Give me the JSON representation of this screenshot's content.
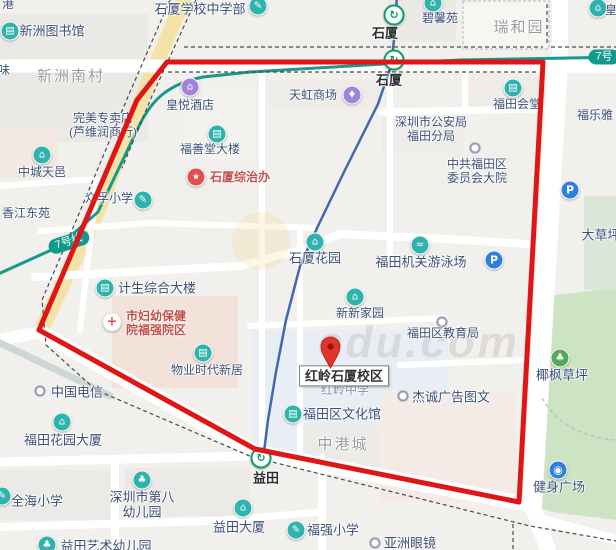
{
  "map": {
    "colors": {
      "boundary": "#e01515",
      "metro_line7": "#17998c",
      "poi_teal": "#2fb3ac",
      "poi_purple": "#a184d8",
      "poi_blue": "#2f7fe0",
      "poi_red": "#e0504c",
      "river": "#3f68b0",
      "park_green": "#cde4c4"
    },
    "watermark": "edu.com",
    "badges": [
      {
        "text": "7号线",
        "x": 69,
        "y": 242,
        "rot": -18
      },
      {
        "text": "7号",
        "x": 604,
        "y": 57,
        "rot": 0
      }
    ],
    "pois": [
      {
        "id": "shixia-school-middle",
        "label": "石厦学校中学部",
        "style": "big",
        "tx": 200,
        "ty": 9,
        "icon": "school",
        "ix": 258,
        "iy": 6
      },
      {
        "id": "harbor-partial",
        "label": "港",
        "tx": 8,
        "ty": 4
      },
      {
        "id": "xinzhou-library",
        "label": "新洲图书馆",
        "style": "big",
        "tx": 52,
        "ty": 31,
        "icon": "library",
        "ix": 10,
        "iy": 31
      },
      {
        "id": "bixinyuan",
        "label": "碧馨苑",
        "tx": 440,
        "ty": 18,
        "icon": "residence",
        "ix": 433,
        "iy": 3
      },
      {
        "id": "ruiheyuan",
        "label": "瑞和园",
        "style": "gray",
        "tx": 519,
        "ty": 28
      },
      {
        "id": "huang-partial",
        "label": "皇",
        "tx": 611,
        "ty": 10,
        "icon": "residence",
        "ix": 598,
        "iy": 8
      },
      {
        "id": "shixia-station-north",
        "label": "石厦",
        "style": "station",
        "tx": 385,
        "ty": 33,
        "icon": "metro",
        "ix": 394,
        "iy": 15
      },
      {
        "id": "shixia-station-south",
        "label": "石厦",
        "style": "station",
        "tx": 389,
        "ty": 80,
        "icon": "metro",
        "ix": 394,
        "iy": 60
      },
      {
        "id": "tianhong-mall",
        "label": "天虹商场",
        "tx": 313,
        "ty": 95,
        "icon": "shopping",
        "ix": 352,
        "iy": 95
      },
      {
        "id": "fuleya",
        "label": "福乐雅",
        "tx": 595,
        "ty": 115
      },
      {
        "id": "futian-huitang",
        "label": "福田会堂",
        "tx": 517,
        "ty": 104,
        "icon": "office",
        "ix": 513,
        "iy": 88
      },
      {
        "id": "shenzhen-police",
        "lines": [
          "深圳市公安局",
          "福田分局"
        ],
        "tx": 431,
        "ty": 129
      },
      {
        "id": "futian-committee",
        "lines": [
          "中共福田区",
          "委员会大院"
        ],
        "tx": 477,
        "ty": 171,
        "icon": "dot",
        "ix": 475,
        "iy": 148
      },
      {
        "id": "wanmei-store",
        "lines": [
          "完美专卖店",
          "(芦维润商行)"
        ],
        "tx": 103,
        "ty": 125
      },
      {
        "id": "huangyue-hotel",
        "label": "皇悦酒店",
        "tx": 190,
        "ty": 105,
        "icon": "hotel",
        "ix": 190,
        "iy": 87
      },
      {
        "id": "xinzhou-nancun",
        "label": "新洲南村",
        "style": "gray",
        "tx": 71,
        "ty": 77
      },
      {
        "id": "wei-partial",
        "label": "味",
        "tx": 4,
        "ty": 70
      },
      {
        "id": "fushantang-building",
        "label": "福善堂大楼",
        "tx": 210,
        "ty": 149,
        "icon": "office",
        "ix": 217,
        "iy": 134
      },
      {
        "id": "shixia-zongzhiban",
        "label": "石厦综治办",
        "style": "red",
        "tx": 240,
        "ty": 177,
        "icon": "government",
        "ix": 196,
        "iy": 177
      },
      {
        "id": "zhongfu-primary",
        "label": "众孚小学",
        "tx": 109,
        "ty": 198,
        "icon": "school",
        "ix": 143,
        "iy": 200
      },
      {
        "id": "zhongcheng-tianyi",
        "label": "中城天邑",
        "tx": 42,
        "ty": 172,
        "icon": "residence",
        "ix": 42,
        "iy": 155
      },
      {
        "id": "xiangjiang-dongyuan",
        "label": "香江东苑",
        "tx": 26,
        "ty": 213
      },
      {
        "id": "dacaoping",
        "label": "大草坪",
        "style": "big",
        "tx": 601,
        "ty": 235
      },
      {
        "id": "shixia-huayuan",
        "label": "石厦花园",
        "style": "big",
        "tx": 315,
        "ty": 258,
        "icon": "residence",
        "ix": 315,
        "iy": 242
      },
      {
        "id": "futian-swimming",
        "label": "福田机关游泳场",
        "style": "big",
        "tx": 421,
        "ty": 262,
        "icon": "swim",
        "ix": 420,
        "iy": 245
      },
      {
        "id": "parking-north",
        "label": "",
        "tx": 570,
        "ty": 205,
        "icon": "parking",
        "ix": 570,
        "iy": 190
      },
      {
        "id": "parking-pool",
        "label": "",
        "tx": 494,
        "ty": 275,
        "icon": "parking",
        "ix": 494,
        "iy": 260
      },
      {
        "id": "jisheng-building",
        "label": "计生综合大楼",
        "style": "big",
        "tx": 157,
        "ty": 288,
        "icon": "office",
        "ix": 105,
        "iy": 288
      },
      {
        "id": "fuyou-hospital",
        "lines": [
          "市妇幼保健",
          "院福强院区"
        ],
        "style": "red",
        "tx": 156,
        "ty": 323,
        "icon": "hospital",
        "ix": 112,
        "iy": 322
      },
      {
        "id": "xinxin-jiayuan",
        "label": "新新家园",
        "tx": 360,
        "ty": 313,
        "icon": "residence",
        "ix": 355,
        "iy": 297
      },
      {
        "id": "futian-education",
        "label": "福田区教育局",
        "tx": 443,
        "ty": 333,
        "icon": "dot",
        "ix": 442,
        "iy": 322
      },
      {
        "id": "yefeng-lawn",
        "label": "椰枫草坪",
        "style": "big",
        "tx": 562,
        "ty": 375,
        "icon": "park",
        "ix": 560,
        "iy": 358
      },
      {
        "id": "wuye-shidai",
        "label": "物业时代新居",
        "tx": 207,
        "ty": 370,
        "icon": "office",
        "ix": 203,
        "iy": 353
      },
      {
        "id": "hongling-middle",
        "label": "红岭中学",
        "style": "muted",
        "tx": 345,
        "ty": 390
      },
      {
        "id": "hongling-shixia-campus",
        "label": "红岭石厦校区",
        "style": "box",
        "tx": 344,
        "ty": 376
      },
      {
        "id": "china-telecom",
        "label": "中国电信",
        "style": "big",
        "tx": 77,
        "ty": 392,
        "icon": "dot",
        "ix": 40,
        "iy": 391
      },
      {
        "id": "jiecheng-ad",
        "label": "杰诚广告图文",
        "style": "big",
        "tx": 451,
        "ty": 397,
        "icon": "dot",
        "ix": 403,
        "iy": 396
      },
      {
        "id": "futian-culture-hall",
        "label": "福田区文化馆",
        "style": "big",
        "tx": 342,
        "ty": 414,
        "icon": "office",
        "ix": 293,
        "iy": 414
      },
      {
        "id": "zhonggangcheng",
        "label": "中港城",
        "style": "gray",
        "tx": 343,
        "ty": 445
      },
      {
        "id": "futian-garden-tower",
        "label": "福田花园大厦",
        "style": "big",
        "tx": 63,
        "ty": 440,
        "icon": "residence",
        "ix": 62,
        "iy": 422
      },
      {
        "id": "yitian-station",
        "label": "益田",
        "style": "station",
        "tx": 266,
        "ty": 478,
        "icon": "metro",
        "ix": 261,
        "iy": 458
      },
      {
        "id": "quanhai-primary",
        "label": "全海小学",
        "style": "big",
        "tx": 37,
        "ty": 501,
        "icon": "school",
        "ix": 2,
        "iy": 496
      },
      {
        "id": "no8-kindergarten",
        "lines": [
          "深圳市第八",
          "幼儿园"
        ],
        "style": "big",
        "tx": 142,
        "ty": 505,
        "icon": "kindergarten",
        "ix": 142,
        "iy": 480
      },
      {
        "id": "jianshen-square",
        "label": "健身广场",
        "style": "big",
        "tx": 559,
        "ty": 487,
        "icon": "gym",
        "ix": 558,
        "iy": 470
      },
      {
        "id": "yitian-tower",
        "label": "益田大厦",
        "style": "big",
        "tx": 239,
        "ty": 527,
        "icon": "residence",
        "ix": 243,
        "iy": 508
      },
      {
        "id": "fuqiang-primary",
        "label": "福强小学",
        "style": "big",
        "tx": 333,
        "ty": 530,
        "icon": "school",
        "ix": 296,
        "iy": 530
      },
      {
        "id": "yazhou-glasses",
        "label": "亚洲眼镜",
        "style": "big",
        "tx": 410,
        "ty": 543,
        "icon": "dot",
        "ix": 375,
        "iy": 543
      },
      {
        "id": "yitian-art-kindergarten",
        "label": "益田艺术幼儿园",
        "style": "big",
        "tx": 106,
        "ty": 546,
        "icon": "kindergarten",
        "ix": 47,
        "iy": 545
      }
    ]
  }
}
